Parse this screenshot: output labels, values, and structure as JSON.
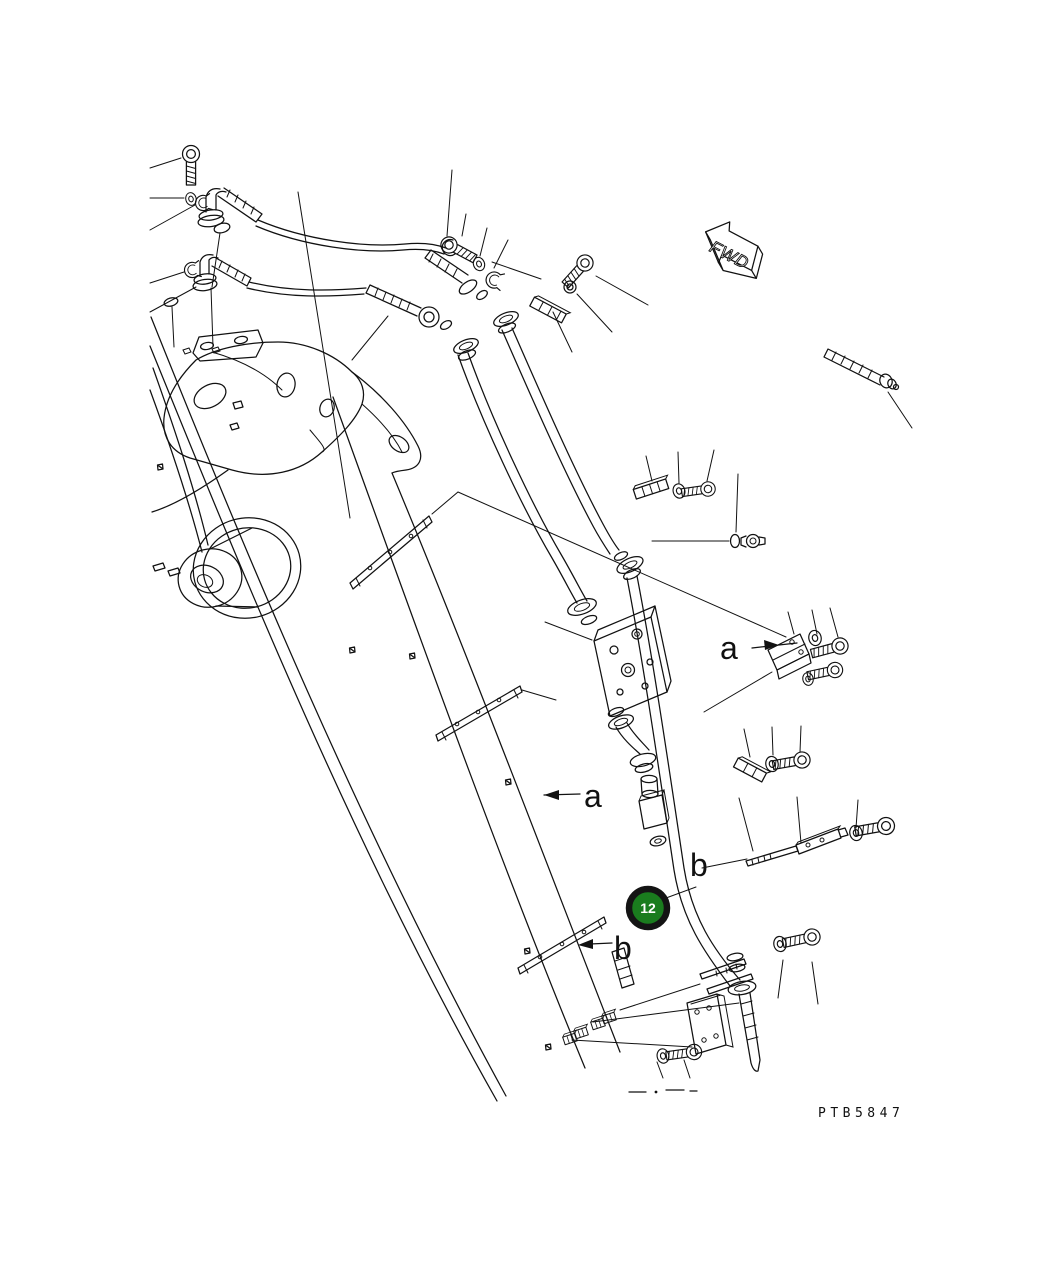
{
  "page": {
    "background_color": "#ffffff",
    "line_color": "#111111"
  },
  "diagram": {
    "type": "exploded-parts-diagram",
    "drawing_number": "PTB5847",
    "fwd_indicator": {
      "label": "FWD"
    },
    "callouts": [
      {
        "id": "a-left",
        "label": "a"
      },
      {
        "id": "a-right",
        "label": "a"
      },
      {
        "id": "b-upper",
        "label": "b"
      },
      {
        "id": "b-lower",
        "label": "b"
      }
    ],
    "part_marker": {
      "number": "12",
      "fill_color": "#1a7c1e",
      "ring_color": "#141414",
      "text_color": "#ffffff"
    }
  }
}
